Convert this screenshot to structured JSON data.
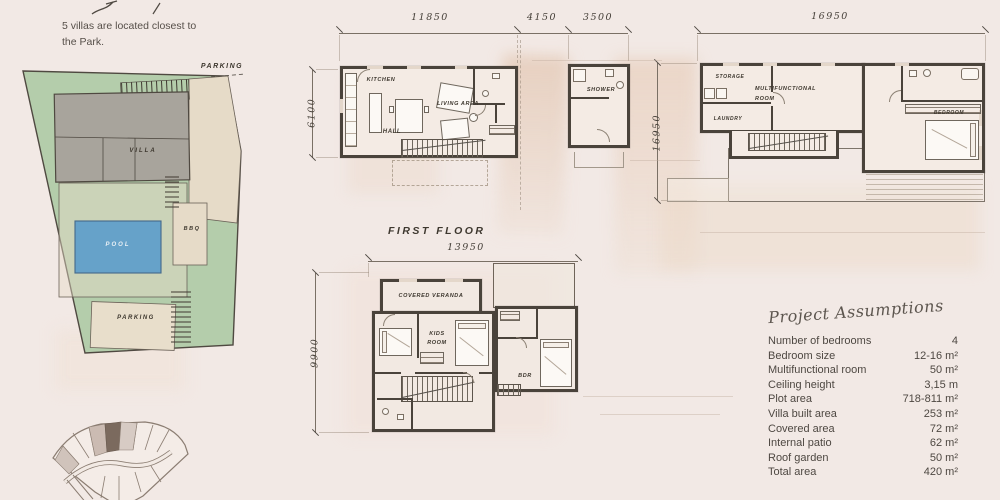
{
  "note": {
    "line1": "5  villas are located closest to",
    "line2": "the Park."
  },
  "site_plan": {
    "parking_top_label": "PARKING",
    "villa_label": "VILLA",
    "pool_label": "POOL",
    "bbq_label": "BBQ",
    "parking_bottom_label": "PARKING"
  },
  "ground_floor": {
    "dim_top_1": "11850",
    "dim_top_2": "4150",
    "dim_top_3": "3500",
    "dim_left": "6100",
    "kitchen": "KITCHEN",
    "living_area": "LIVING AREA",
    "hall": "HALL",
    "shower": "SHOWER"
  },
  "upper_plan": {
    "dim_top": "16950",
    "dim_left": "16950",
    "storage": "STORAGE",
    "multifunctional_line1": "MULTIFUNCTIONAL",
    "multifunctional_line2": "ROOM",
    "laundry": "LAUNDRY",
    "bedroom": "BEDROOM"
  },
  "first_floor": {
    "title": "FIRST FLOOR",
    "dim_top": "13950",
    "dim_left": "9900",
    "covered_veranda": "COVERED VERANDA",
    "kids_line1": "KIDS",
    "kids_line2": "ROOM",
    "bdr": "BDR"
  },
  "assumptions": {
    "title": "Project Assumptions",
    "rows": [
      {
        "label": "Number of bedrooms",
        "value": "4"
      },
      {
        "label": "Bedroom size",
        "value": "12-16 m²"
      },
      {
        "label": "Multifunctional room",
        "value": "50 m²"
      },
      {
        "label": "Ceiling height",
        "value": "3,15 m"
      },
      {
        "label": "Plot area",
        "value": "718-811 m²"
      },
      {
        "label": "Villa built area",
        "value": "253 m²"
      },
      {
        "label": "Covered area",
        "value": "72 m²"
      },
      {
        "label": "Internal patio",
        "value": "62 m²"
      },
      {
        "label": "Roof garden",
        "value": "50 m²"
      },
      {
        "label": "Total area",
        "value": "420 m²"
      }
    ]
  },
  "colors": {
    "background": "#f2e9e5",
    "plot_green": "#b4cdab",
    "pool_blue": "#66a2c9",
    "villa_gray": "#a8a49c",
    "sand_beige": "#e6dbc8",
    "wall_dark": "#4a433b",
    "map_highlight_plot": "#7b6a5e"
  }
}
